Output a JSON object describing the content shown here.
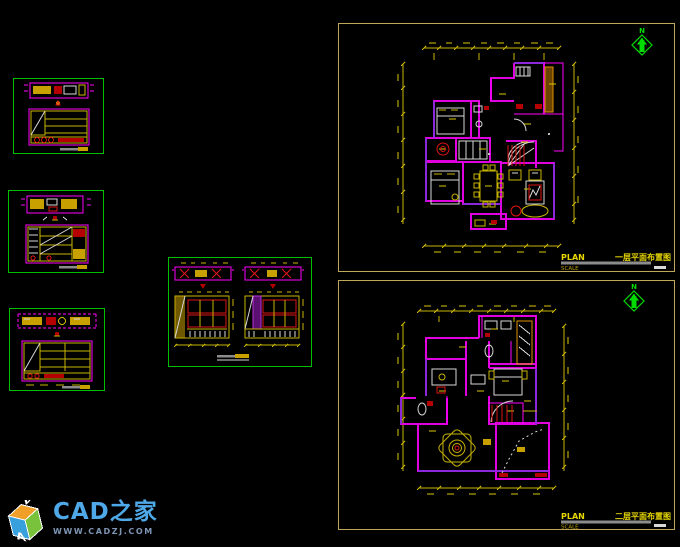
{
  "workspace": {
    "name": "cad-model-space",
    "background": "#000000"
  },
  "colors": {
    "panel_border_green": "#00BE00",
    "panel_border_yellow": "#BFA75A",
    "wall_magenta": "#FF00FF",
    "wall_purple": "#8C28DC",
    "dimension_yellow": "#C8B400",
    "detail_white": "#D8D8D8",
    "detail_red": "#DC1414",
    "cabinet_orange": "#E09000",
    "north_green": "#00DC00",
    "title_yellow": "#E8D800"
  },
  "north_label": "N",
  "sheets": {
    "floor1": {
      "plan_label": "PLAN",
      "scale_label": "SCALE",
      "title": "一层平面布置图"
    },
    "floor2": {
      "plan_label": "PLAN",
      "scale_label": "SCALE",
      "title": "二层平面布置图"
    }
  },
  "logo": {
    "title": "CAD之家",
    "url": "WWW.CADZJ.COM",
    "cube_front_letter": "A",
    "cube_side_letter": "D"
  }
}
